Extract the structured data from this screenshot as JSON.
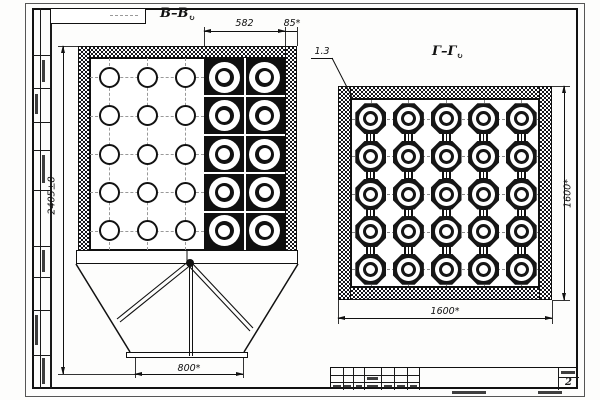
{
  "views": {
    "left": {
      "label": "В–В",
      "rotation_mark": "↻",
      "dims": {
        "bundle_width": "582",
        "edge_offset": "85*",
        "overall_height": "2405±8",
        "outlet_width": "800*"
      },
      "plain_tubes": {
        "cols": 3,
        "rows": 5
      },
      "ring_tubes": {
        "cols": 2,
        "rows": 5
      }
    },
    "right": {
      "label": "Г–Г",
      "rotation_mark": "↻",
      "leader_note": "1.3",
      "dims": {
        "width": "1600*",
        "height": "1600*"
      },
      "tubes": {
        "cols": 5,
        "rows": 5
      }
    }
  },
  "title_block": {
    "sheet_number": "2"
  },
  "colors": {
    "ink": "#1a1a1a",
    "paper": "#fdfdfc"
  }
}
